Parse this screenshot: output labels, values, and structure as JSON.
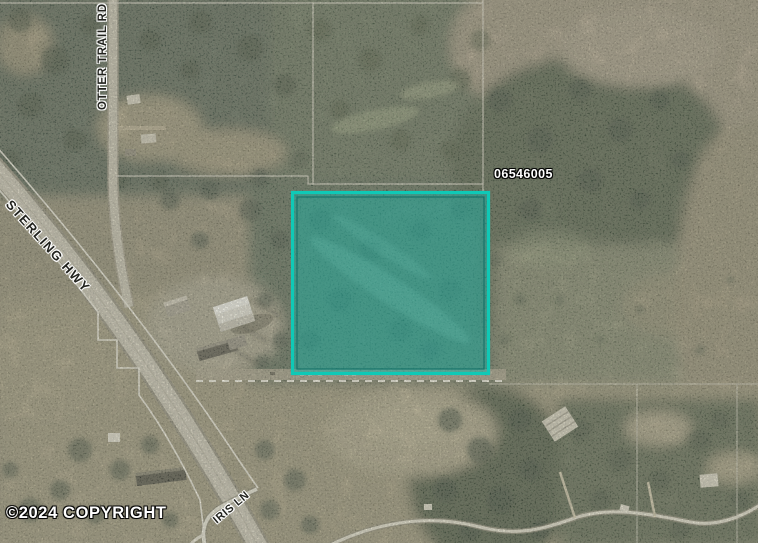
{
  "map": {
    "parcel": {
      "id": "06546005",
      "border_color": "#0fc9b6",
      "fill_color": "rgba(28,176,161,0.5)"
    },
    "roads": [
      {
        "name": "STERLING HWY"
      },
      {
        "name": "OTTER TRAIL RD"
      },
      {
        "name": "IRIS LN"
      }
    ],
    "copyright": "©2024 COPYRIGHT"
  }
}
